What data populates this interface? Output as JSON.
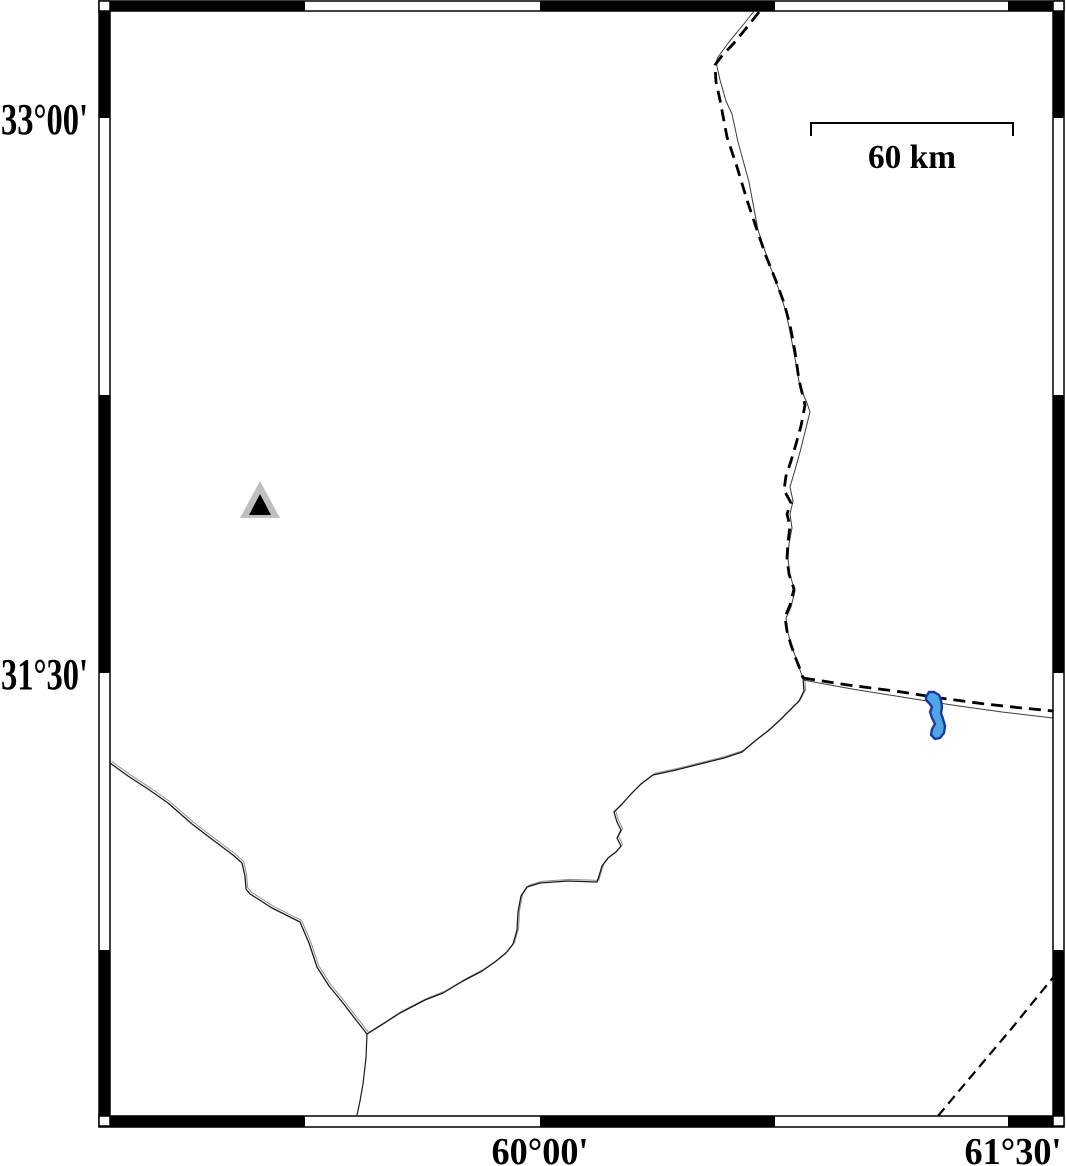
{
  "map": {
    "axes": {
      "left_labels": [
        {
          "text": "33°00'",
          "cy": 118
        },
        {
          "text": "31°30'",
          "cy": 673
        }
      ],
      "bottom_labels": [
        {
          "text": "60°00'",
          "cx": 540
        },
        {
          "text": "61°30'",
          "cx": 1013
        }
      ]
    },
    "scale_bar": {
      "label": "60 km",
      "x1": 811,
      "x2": 1013,
      "y": 123,
      "tick_drop": 13,
      "label_cx": 912,
      "label_baseline": 168
    },
    "frame": {
      "outer": [
        99,
        1,
        965,
        1126
      ],
      "inner": [
        110,
        11,
        943,
        1105
      ],
      "top_black_x": [
        [
          110,
          305
        ],
        [
          540,
          775
        ],
        [
          1008,
          1053
        ]
      ],
      "bottom_black_x": [
        [
          110,
          305
        ],
        [
          540,
          775
        ],
        [
          1008,
          1053
        ]
      ],
      "left_black_y": [
        [
          11,
          118
        ],
        [
          395,
          673
        ],
        [
          950,
          1116
        ]
      ],
      "right_black_y": [
        [
          11,
          118
        ],
        [
          395,
          673
        ],
        [
          950,
          1116
        ]
      ]
    },
    "features": {
      "border_dashed_north": [
        [
          759,
          12
        ],
        [
          748,
          26
        ],
        [
          734,
          43
        ],
        [
          721,
          57
        ],
        [
          715,
          65
        ],
        [
          716,
          82
        ],
        [
          720,
          100
        ],
        [
          727,
          137
        ],
        [
          737,
          167
        ],
        [
          747,
          200
        ],
        [
          757,
          230
        ],
        [
          766,
          256
        ],
        [
          776,
          281
        ],
        [
          784,
          303
        ],
        [
          790,
          325
        ],
        [
          795,
          352
        ],
        [
          799,
          380
        ],
        [
          805,
          405
        ],
        [
          801,
          426
        ],
        [
          796,
          444
        ],
        [
          791,
          461
        ],
        [
          786,
          476
        ],
        [
          784,
          490
        ],
        [
          791,
          503
        ],
        [
          787,
          514
        ],
        [
          790,
          526
        ],
        [
          788,
          542
        ],
        [
          787,
          558
        ],
        [
          789,
          574
        ],
        [
          794,
          589
        ],
        [
          790,
          605
        ],
        [
          785,
          617
        ],
        [
          787,
          631
        ],
        [
          791,
          645
        ],
        [
          796,
          659
        ],
        [
          800,
          669
        ],
        [
          803,
          678
        ]
      ],
      "line_solid_north": [
        [
          755,
          10
        ],
        [
          743,
          25
        ],
        [
          729,
          42
        ],
        [
          718,
          57
        ],
        [
          716,
          62
        ],
        [
          720,
          80
        ],
        [
          726,
          101
        ],
        [
          732,
          114
        ],
        [
          738,
          142
        ],
        [
          749,
          182
        ],
        [
          758,
          230
        ],
        [
          769,
          263
        ],
        [
          779,
          290
        ],
        [
          786,
          312
        ],
        [
          791,
          337
        ],
        [
          796,
          364
        ],
        [
          800,
          387
        ],
        [
          807,
          403
        ],
        [
          810,
          412
        ],
        [
          805,
          432
        ],
        [
          800,
          452
        ],
        [
          795,
          470
        ],
        [
          790,
          487
        ],
        [
          793,
          501
        ],
        [
          790,
          514
        ],
        [
          792,
          528
        ],
        [
          789,
          544
        ],
        [
          788,
          559
        ],
        [
          790,
          575
        ],
        [
          795,
          591
        ],
        [
          791,
          607
        ],
        [
          786,
          618
        ],
        [
          788,
          633
        ],
        [
          792,
          647
        ],
        [
          797,
          661
        ],
        [
          800,
          670
        ],
        [
          803,
          678
        ]
      ],
      "border_dashed_east": [
        [
          803,
          678
        ],
        [
          848,
          685
        ],
        [
          895,
          691
        ],
        [
          940,
          698
        ],
        [
          985,
          704
        ],
        [
          1022,
          708
        ],
        [
          1053,
          711
        ]
      ],
      "line_solid_east": [
        [
          803,
          680
        ],
        [
          852,
          689
        ],
        [
          902,
          697
        ],
        [
          952,
          705
        ],
        [
          1002,
          712
        ],
        [
          1053,
          718
        ]
      ],
      "river_main": [
        [
          803,
          678
        ],
        [
          804,
          691
        ],
        [
          799,
          701
        ],
        [
          790,
          710
        ],
        [
          780,
          720
        ],
        [
          768,
          731
        ],
        [
          755,
          741
        ],
        [
          742,
          752
        ],
        [
          724,
          758
        ],
        [
          700,
          764
        ],
        [
          676,
          770
        ],
        [
          653,
          775
        ],
        [
          641,
          784
        ],
        [
          631,
          794
        ],
        [
          622,
          804
        ],
        [
          614,
          812
        ],
        [
          617,
          822
        ],
        [
          621,
          830
        ],
        [
          617,
          838
        ],
        [
          621,
          846
        ],
        [
          616,
          852
        ],
        [
          608,
          858
        ],
        [
          602,
          866
        ],
        [
          599,
          876
        ],
        [
          597,
          882
        ],
        [
          568,
          881
        ],
        [
          540,
          883
        ],
        [
          527,
          887
        ],
        [
          521,
          896
        ],
        [
          518,
          912
        ],
        [
          517,
          930
        ],
        [
          513,
          944
        ],
        [
          506,
          953
        ],
        [
          495,
          962
        ],
        [
          482,
          971
        ],
        [
          463,
          981
        ],
        [
          443,
          993
        ],
        [
          425,
          1000
        ],
        [
          400,
          1013
        ],
        [
          383,
          1024
        ],
        [
          367,
          1034
        ]
      ],
      "river_west": [
        [
          110,
          763
        ],
        [
          128,
          776
        ],
        [
          148,
          789
        ],
        [
          168,
          803
        ],
        [
          192,
          824
        ],
        [
          213,
          840
        ],
        [
          233,
          855
        ],
        [
          242,
          863
        ],
        [
          245,
          876
        ],
        [
          246,
          889
        ],
        [
          250,
          894
        ],
        [
          258,
          899
        ],
        [
          272,
          908
        ],
        [
          288,
          916
        ],
        [
          300,
          922
        ],
        [
          309,
          943
        ],
        [
          317,
          967
        ],
        [
          329,
          986
        ],
        [
          343,
          1003
        ],
        [
          356,
          1020
        ],
        [
          367,
          1034
        ]
      ],
      "river_south": [
        [
          367,
          1034
        ],
        [
          366,
          1058
        ],
        [
          363,
          1084
        ],
        [
          360,
          1101
        ],
        [
          357,
          1115
        ]
      ],
      "border_dashed_southeast": [
        [
          938,
          1116
        ],
        [
          958,
          1092
        ],
        [
          985,
          1060
        ],
        [
          1012,
          1028
        ],
        [
          1038,
          996
        ],
        [
          1056,
          974
        ]
      ],
      "lake": [
        [
          926,
          697
        ],
        [
          929,
          692
        ],
        [
          934,
          692
        ],
        [
          939,
          695
        ],
        [
          941,
          700
        ],
        [
          942,
          707
        ],
        [
          941,
          713
        ],
        [
          943,
          719
        ],
        [
          945,
          726
        ],
        [
          944,
          733
        ],
        [
          940,
          738
        ],
        [
          935,
          739
        ],
        [
          931,
          735
        ],
        [
          932,
          729
        ],
        [
          935,
          724
        ],
        [
          932,
          718
        ],
        [
          930,
          712
        ],
        [
          932,
          707
        ],
        [
          929,
          703
        ],
        [
          926,
          700
        ]
      ],
      "triangle_outer": [
        [
          240,
          518
        ],
        [
          280,
          518
        ],
        [
          260,
          481
        ]
      ],
      "triangle_inner": [
        [
          249,
          515
        ],
        [
          271,
          515
        ],
        [
          260,
          494
        ]
      ]
    },
    "colors": {
      "line": "#000000",
      "faint_line": "#3c3c3c",
      "river_echo": "#909090",
      "lake_fill": "#4FA6E4",
      "lake_stroke": "#1A3A9C",
      "triangle_fill": "#BFBFBF",
      "triangle_core": "#000000",
      "frame_black": "#000000",
      "frame_white": "#ffffff"
    }
  }
}
